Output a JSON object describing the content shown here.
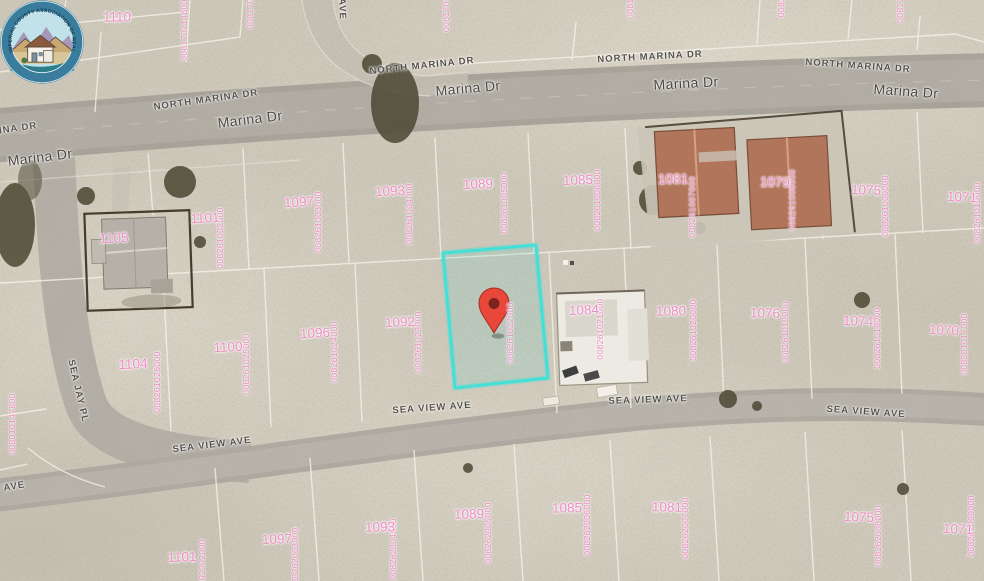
{
  "map": {
    "kind": "satellite-parcel-map",
    "highlight": {
      "apn": "008261022000",
      "color": "#3fe0d8"
    },
    "pin": {
      "color": "#e8473a"
    },
    "colors": {
      "sand": "#cfc9bb",
      "road": "#a7a39a",
      "parcel_line": "#f5f2e8",
      "parcel_number": "#ef8cc6",
      "street_label": "#55524b"
    }
  },
  "streets": {
    "labels": [
      {
        "t": "Marina Dr",
        "x": 40,
        "y": 157,
        "r": -7,
        "cls": "lg"
      },
      {
        "t": "Marina Dr",
        "x": 250,
        "y": 119,
        "r": -7,
        "cls": "lg"
      },
      {
        "t": "Marina Dr",
        "x": 468,
        "y": 88,
        "r": -5,
        "cls": "lg"
      },
      {
        "t": "Marina Dr",
        "x": 686,
        "y": 83,
        "r": -3,
        "cls": "lg"
      },
      {
        "t": "Marina Dr",
        "x": 906,
        "y": 91,
        "r": 4,
        "cls": "lg"
      },
      {
        "t": "NORTH MARINA DR",
        "x": -15,
        "y": 133,
        "r": -8,
        "cls": "sm"
      },
      {
        "t": "NORTH MARINA DR",
        "x": 206,
        "y": 100,
        "r": -8,
        "cls": "sm"
      },
      {
        "t": "NORTH MARINA DR",
        "x": 422,
        "y": 66,
        "r": -6,
        "cls": "sm"
      },
      {
        "t": "NORTH MARINA DR",
        "x": 650,
        "y": 57,
        "r": -3,
        "cls": "sm"
      },
      {
        "t": "NORTH MARINA DR",
        "x": 858,
        "y": 66,
        "r": 4,
        "cls": "sm"
      },
      {
        "t": "SEA VIEW AVE",
        "x": -14,
        "y": 491,
        "r": -9,
        "cls": "sm"
      },
      {
        "t": "SEA VIEW AVE",
        "x": 212,
        "y": 445,
        "r": -7,
        "cls": "sm"
      },
      {
        "t": "SEA VIEW AVE",
        "x": 432,
        "y": 408,
        "r": -4,
        "cls": "sm"
      },
      {
        "t": "SEA VIEW AVE",
        "x": 648,
        "y": 400,
        "r": -2,
        "cls": "sm"
      },
      {
        "t": "SEA VIEW AVE",
        "x": 866,
        "y": 412,
        "r": 4,
        "cls": "sm"
      },
      {
        "t": "SEA JAY PL",
        "x": 78,
        "y": 391,
        "r": 77,
        "cls": "sm"
      },
      {
        "t": "AVE",
        "x": 342,
        "y": 9,
        "r": 88,
        "cls": "sm"
      }
    ]
  },
  "parcel_numbers": [
    {
      "t": "1110",
      "x": 117,
      "y": 17,
      "r": 0
    },
    {
      "t": "1101",
      "x": 205,
      "y": 218,
      "r": -3
    },
    {
      "t": "1105",
      "x": 114,
      "y": 238,
      "r": -3
    },
    {
      "t": "1097",
      "x": 299,
      "y": 202,
      "r": -3
    },
    {
      "t": "1093",
      "x": 390,
      "y": 191,
      "r": -3
    },
    {
      "t": "1089",
      "x": 478,
      "y": 184,
      "r": -2
    },
    {
      "t": "1085",
      "x": 578,
      "y": 180,
      "r": -2
    },
    {
      "t": "1081",
      "x": 673,
      "y": 179,
      "r": -1
    },
    {
      "t": "1079",
      "x": 775,
      "y": 182,
      "r": 1
    },
    {
      "t": "1075",
      "x": 866,
      "y": 190,
      "r": 2
    },
    {
      "t": "1071",
      "x": 962,
      "y": 197,
      "r": 3
    },
    {
      "t": "1104",
      "x": 133,
      "y": 364,
      "r": -3
    },
    {
      "t": "1100",
      "x": 228,
      "y": 347,
      "r": -3
    },
    {
      "t": "1096",
      "x": 315,
      "y": 333,
      "r": -3
    },
    {
      "t": "1092",
      "x": 400,
      "y": 322,
      "r": -2
    },
    {
      "t": "1084",
      "x": 584,
      "y": 310,
      "r": -2
    },
    {
      "t": "1080",
      "x": 671,
      "y": 311,
      "r": -1
    },
    {
      "t": "1076",
      "x": 765,
      "y": 313,
      "r": 1
    },
    {
      "t": "1074",
      "x": 858,
      "y": 321,
      "r": 2
    },
    {
      "t": "1070",
      "x": 944,
      "y": 330,
      "r": 3
    },
    {
      "t": "1101",
      "x": 182,
      "y": 557,
      "r": -2
    },
    {
      "t": "1097",
      "x": 277,
      "y": 539,
      "r": -2
    },
    {
      "t": "1093",
      "x": 380,
      "y": 527,
      "r": -1
    },
    {
      "t": "1089",
      "x": 469,
      "y": 514,
      "r": -1
    },
    {
      "t": "1085",
      "x": 567,
      "y": 508,
      "r": 0
    },
    {
      "t": "1081",
      "x": 667,
      "y": 507,
      "r": 1
    },
    {
      "t": "1075",
      "x": 859,
      "y": 517,
      "r": 2
    },
    {
      "t": "1071",
      "x": 958,
      "y": 529,
      "r": 3
    }
  ],
  "apn_numbers": [
    {
      "t": "008170214800",
      "x": 184,
      "y": 30
    },
    {
      "t": "0081701",
      "x": 250,
      "y": 11
    },
    {
      "t": "0081701",
      "x": 446,
      "y": 14
    },
    {
      "t": "00817",
      "x": 630,
      "y": 6
    },
    {
      "t": "0081",
      "x": 781,
      "y": 7
    },
    {
      "t": "00817",
      "x": 900,
      "y": 10
    },
    {
      "t": "008261002000",
      "x": 220,
      "y": 238
    },
    {
      "t": "008261003000",
      "x": 318,
      "y": 222
    },
    {
      "t": "008261004000",
      "x": 409,
      "y": 214
    },
    {
      "t": "008261005000",
      "x": 504,
      "y": 203
    },
    {
      "t": "008261006000",
      "x": 597,
      "y": 200
    },
    {
      "t": "008261007000",
      "x": 692,
      "y": 207
    },
    {
      "t": "008261008000",
      "x": 792,
      "y": 200
    },
    {
      "t": "008261009000",
      "x": 885,
      "y": 206
    },
    {
      "t": "008261010000",
      "x": 977,
      "y": 213
    },
    {
      "t": "008261026000",
      "x": 157,
      "y": 382
    },
    {
      "t": "008261025000",
      "x": 246,
      "y": 364
    },
    {
      "t": "008261024000",
      "x": 334,
      "y": 352
    },
    {
      "t": "008261023000",
      "x": 418,
      "y": 342
    },
    {
      "t": "008261022000",
      "x": 510,
      "y": 333
    },
    {
      "t": "008261021000",
      "x": 600,
      "y": 329
    },
    {
      "t": "008261020000",
      "x": 693,
      "y": 330
    },
    {
      "t": "008261019000",
      "x": 785,
      "y": 332
    },
    {
      "t": "008261018000",
      "x": 877,
      "y": 338
    },
    {
      "t": "008261017000",
      "x": 964,
      "y": 344
    },
    {
      "t": "008262002000",
      "x": 202,
      "y": 570
    },
    {
      "t": "008262003000",
      "x": 295,
      "y": 558
    },
    {
      "t": "008262004000",
      "x": 393,
      "y": 549
    },
    {
      "t": "008262005000",
      "x": 488,
      "y": 533
    },
    {
      "t": "008262006000",
      "x": 587,
      "y": 525
    },
    {
      "t": "008262007000",
      "x": 685,
      "y": 528
    },
    {
      "t": "008262008000",
      "x": 878,
      "y": 536
    },
    {
      "t": "008262009000",
      "x": 971,
      "y": 526
    },
    {
      "t": "008010147800",
      "x": 12,
      "y": 424
    }
  ],
  "logo": {
    "arc_text": "IMPERIAL COUNTY ASSOCIATION OF REALTORS"
  }
}
